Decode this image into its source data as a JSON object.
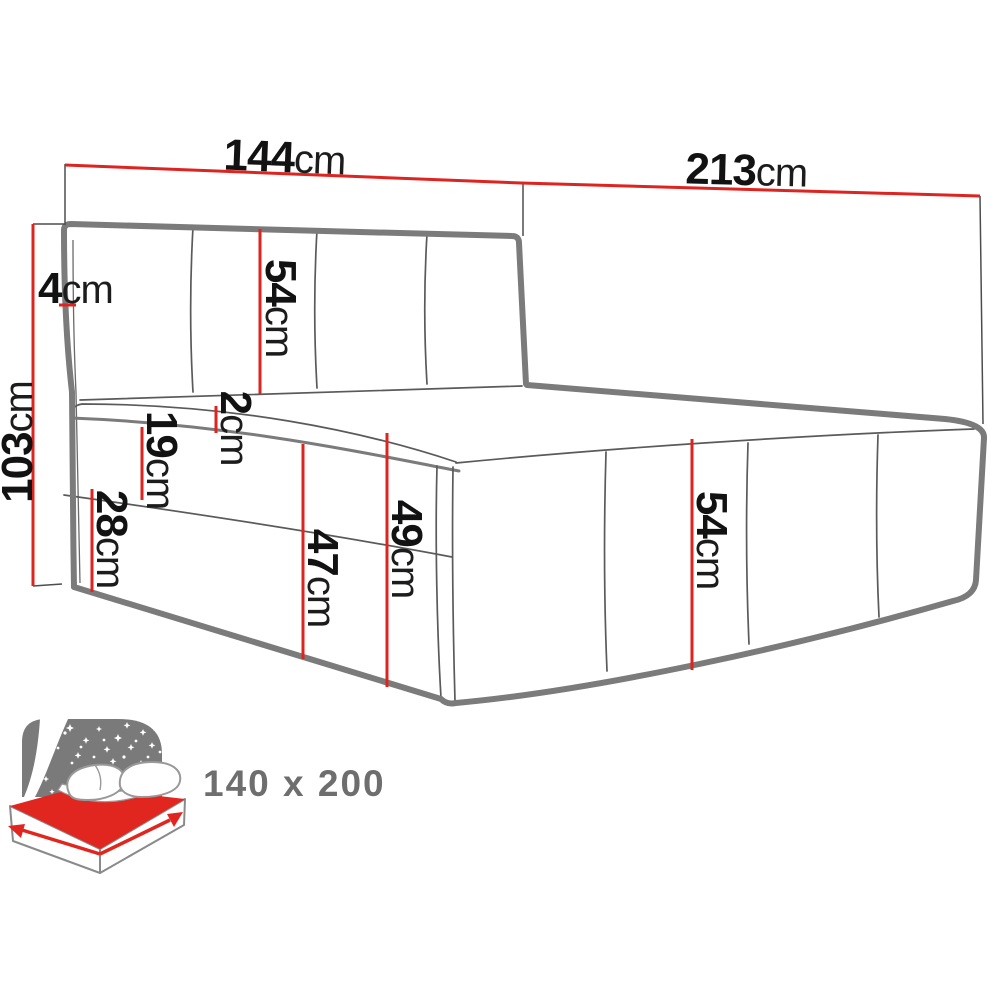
{
  "dimensions": {
    "width": {
      "value": "144",
      "unit": "cm"
    },
    "length": {
      "value": "213",
      "unit": "cm"
    },
    "height": {
      "value": "103",
      "unit": "cm"
    },
    "headboard_side": {
      "value": "4",
      "unit": "cm"
    },
    "headboard_panel": {
      "value": "54",
      "unit": "cm"
    },
    "mattress_top": {
      "value": "2",
      "unit": "cm"
    },
    "base_upper": {
      "value": "19",
      "unit": "cm"
    },
    "base_lower": {
      "value": "28",
      "unit": "cm"
    },
    "front_lower": {
      "value": "47",
      "unit": "cm"
    },
    "front_total": {
      "value": "49",
      "unit": "cm"
    },
    "side_panel": {
      "value": "54",
      "unit": "cm"
    }
  },
  "icon": {
    "size_label": "140 x 200"
  },
  "colors": {
    "dimension_red": "#de2420",
    "bed_outline_gray": "#7b7b7b",
    "icon_gray": "#7a7a7a",
    "icon_red": "#e0261f",
    "label_black": "#121212",
    "size_label_gray": "#6e6e6e"
  }
}
